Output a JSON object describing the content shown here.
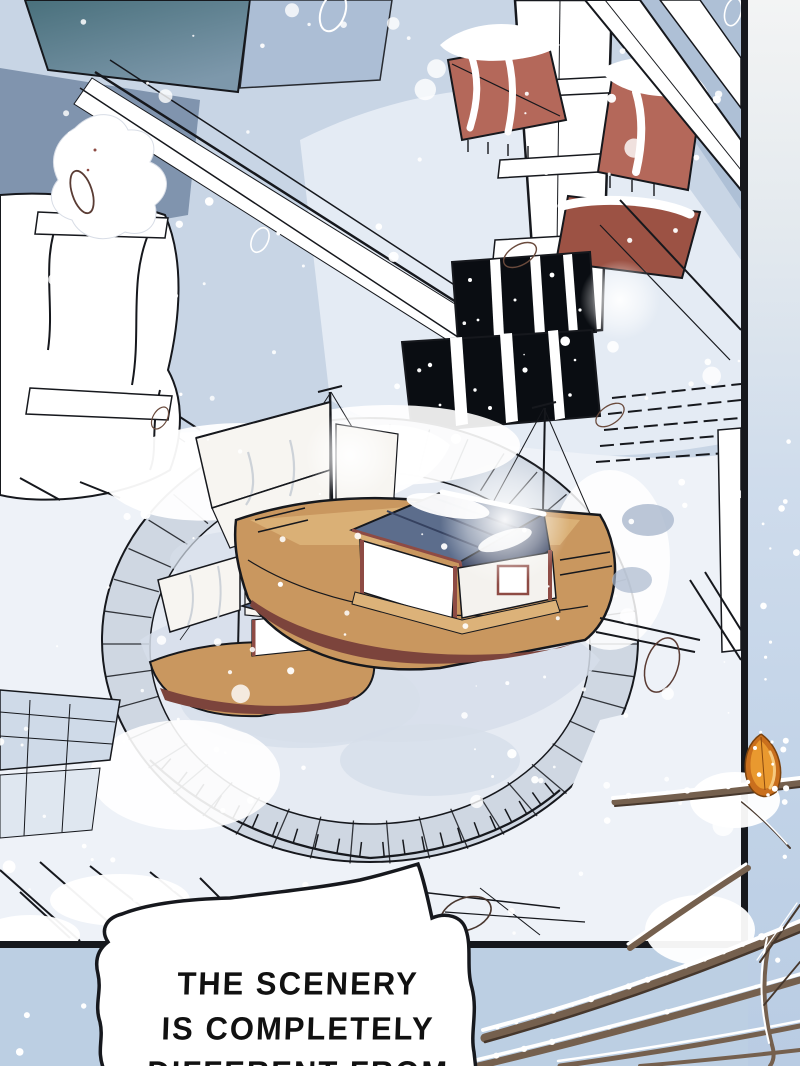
{
  "scene": {
    "description": "Heavy snow falls on a traditional palace courtyard; two roofed pleasure boats sit frozen inside a round stone pond, pagoda roofs rise behind, and snowy branches with one orange leaf cross the panel frame."
  },
  "dialogue": {
    "lines": [
      "THE SCENERY",
      "IS COMPLETELY",
      "DIFFERENT FROM"
    ]
  },
  "palette": {
    "ink": "#16181d",
    "panel_bg": "#c8d5e5",
    "sky_patch": "#9db1cb",
    "pane_blue": "#a9bcd4",
    "slate_wall": "#8094ae",
    "teal_dark": "#49707c",
    "teal_light": "#7d98ab",
    "snow_white": "#ffffff",
    "snow_tint": "#eef2f8",
    "snow_shadow": "#d6deea",
    "shadow_blue": "#aab8cd",
    "stone_fill": "#cfd7e2",
    "pond_ice": "#e6ebf3",
    "roof_red": "#b4685a",
    "roof_red_dark": "#9c5244",
    "window_black": "#0a0d12",
    "hull_tan": "#c9975f",
    "hull_tan_light": "#dcb279",
    "hull_maroon": "#7c443c",
    "trim_maroon": "#8e4b44",
    "cabin_roof": "#5c6d8c",
    "cabin_roof_dark": "#35415f",
    "sail_white": "#f7f5f1",
    "sail_shadow": "#cdd2d8",
    "branch_brown": "#75604e",
    "branch_dark": "#46372c",
    "leaf_orange": "#e9992f",
    "leaf_amber": "#c96f1d",
    "leaf_light": "#f6c97e",
    "outside_top": "#f3f4f4",
    "outside_blue": "#c3d4e8",
    "bubble_fill": "#ffffff",
    "text_ink": "#111111"
  }
}
